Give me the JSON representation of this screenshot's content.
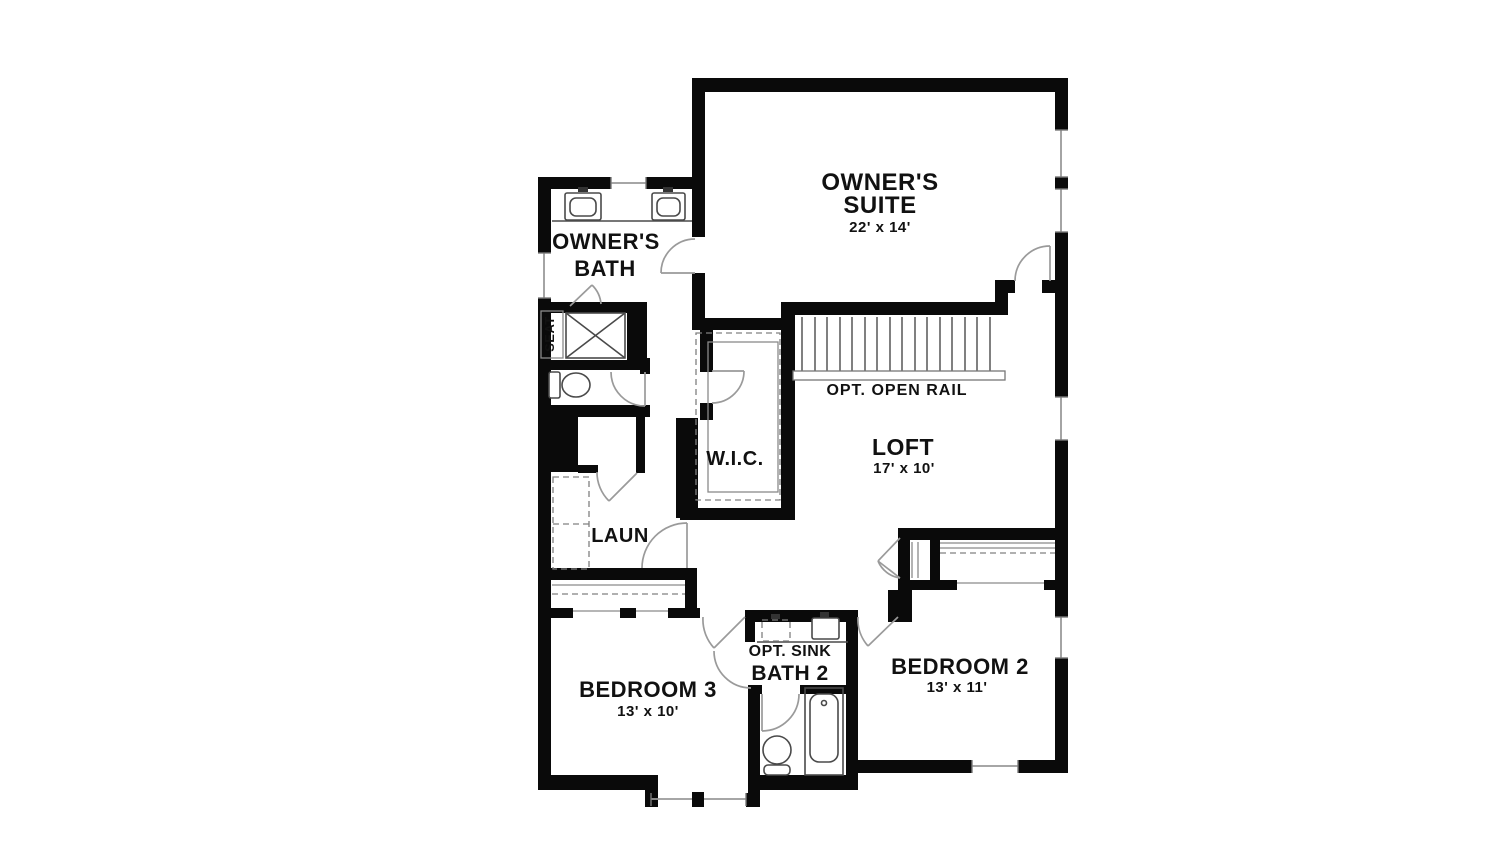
{
  "floor_plan": {
    "colors": {
      "background": "#ffffff",
      "wall": "#0a0a0a",
      "door_arc": "#9a9a9a",
      "fixture": "#4a4a4a",
      "text": "#111111"
    },
    "rooms": {
      "owners_suite": {
        "label_line1": "OWNER'S",
        "label_line2": "SUITE",
        "dimensions": "22' x 14'"
      },
      "owners_bath": {
        "label_line1": "OWNER'S",
        "label_line2": "BATH",
        "seat_label": "SEAT"
      },
      "wic": {
        "label": "W.I.C."
      },
      "loft": {
        "label": "LOFT",
        "dimensions": "17' x 10'"
      },
      "laundry": {
        "label": "LAUN"
      },
      "bedroom3": {
        "label": "BEDROOM 3",
        "dimensions": "13' x 10'"
      },
      "bath2": {
        "label": "BATH 2",
        "opt_sink_label": "OPT. SINK"
      },
      "bedroom2": {
        "label": "BEDROOM 2",
        "dimensions": "13' x 11'"
      },
      "stairs": {
        "label": "OPT. OPEN RAIL"
      }
    }
  }
}
